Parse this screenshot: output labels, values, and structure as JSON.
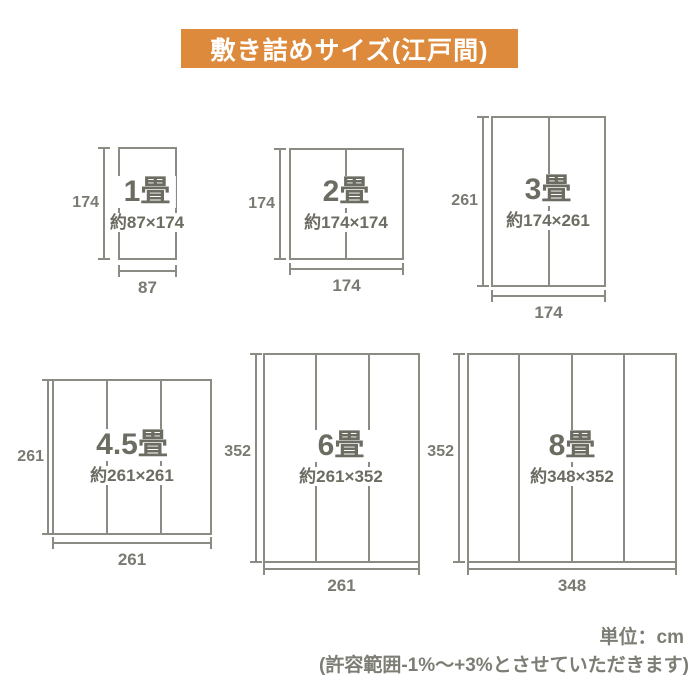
{
  "banner": {
    "title": "敷き詰めサイズ(江戸間)"
  },
  "diagrams": [
    {
      "id": "1jo",
      "label": "1畳",
      "size_label": "約87×174",
      "height_label": "174",
      "width_label": "87",
      "tatami_columns": 1
    },
    {
      "id": "2jo",
      "label": "2畳",
      "size_label": "約174×174",
      "height_label": "174",
      "width_label": "174",
      "tatami_columns": 2
    },
    {
      "id": "3jo",
      "label": "3畳",
      "size_label": "約174×261",
      "height_label": "261",
      "width_label": "174",
      "tatami_columns": 2
    },
    {
      "id": "4_5jo",
      "label": "4.5畳",
      "size_label": "約261×261",
      "height_label": "261",
      "width_label": "261",
      "tatami_columns": 3
    },
    {
      "id": "6jo",
      "label": "6畳",
      "size_label": "約261×352",
      "height_label": "352",
      "width_label": "261",
      "tatami_columns": 3
    },
    {
      "id": "8jo",
      "label": "8畳",
      "size_label": "約348×352",
      "height_label": "352",
      "width_label": "348",
      "tatami_columns": 4
    }
  ],
  "footer": {
    "unit": "単位：cm",
    "tolerance": "(許容範囲-1%〜+3%とさせていただきます)"
  },
  "colors": {
    "banner_bg": "#DD8A3C",
    "banner_text": "#FFFFFF",
    "line": "#8B8B83",
    "label_text": "#6C6C62",
    "dimension_text": "#7A7A72",
    "footer_text": "#7D7D75"
  }
}
